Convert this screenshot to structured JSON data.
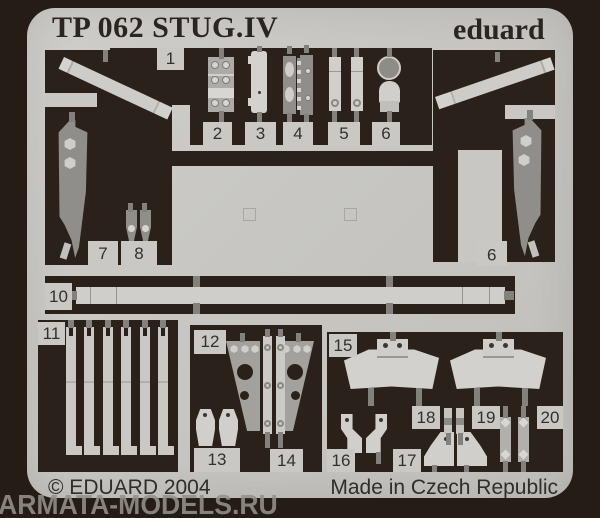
{
  "header": {
    "title": "TP 062 STUG.IV",
    "brand": "eduard"
  },
  "part_numbers": [
    "1",
    "2",
    "3",
    "4",
    "5",
    "6",
    "7",
    "8",
    "9",
    "10",
    "11",
    "12",
    "13",
    "14",
    "15",
    "16",
    "17",
    "18",
    "19",
    "20"
  ],
  "footer": {
    "copyright": "© EDUARD 2004",
    "origin": "Made in Czech Republic"
  },
  "watermark": "ARMATA-MODELS.RU",
  "colors": {
    "background": "#241c15",
    "sheet": "#c8c7c3",
    "etched_area": "#2a211a",
    "part_light": "#d0cfcb",
    "part_half_etched": "#908e8a",
    "sprue_tab": "#83817d",
    "text": "#302e2b"
  }
}
